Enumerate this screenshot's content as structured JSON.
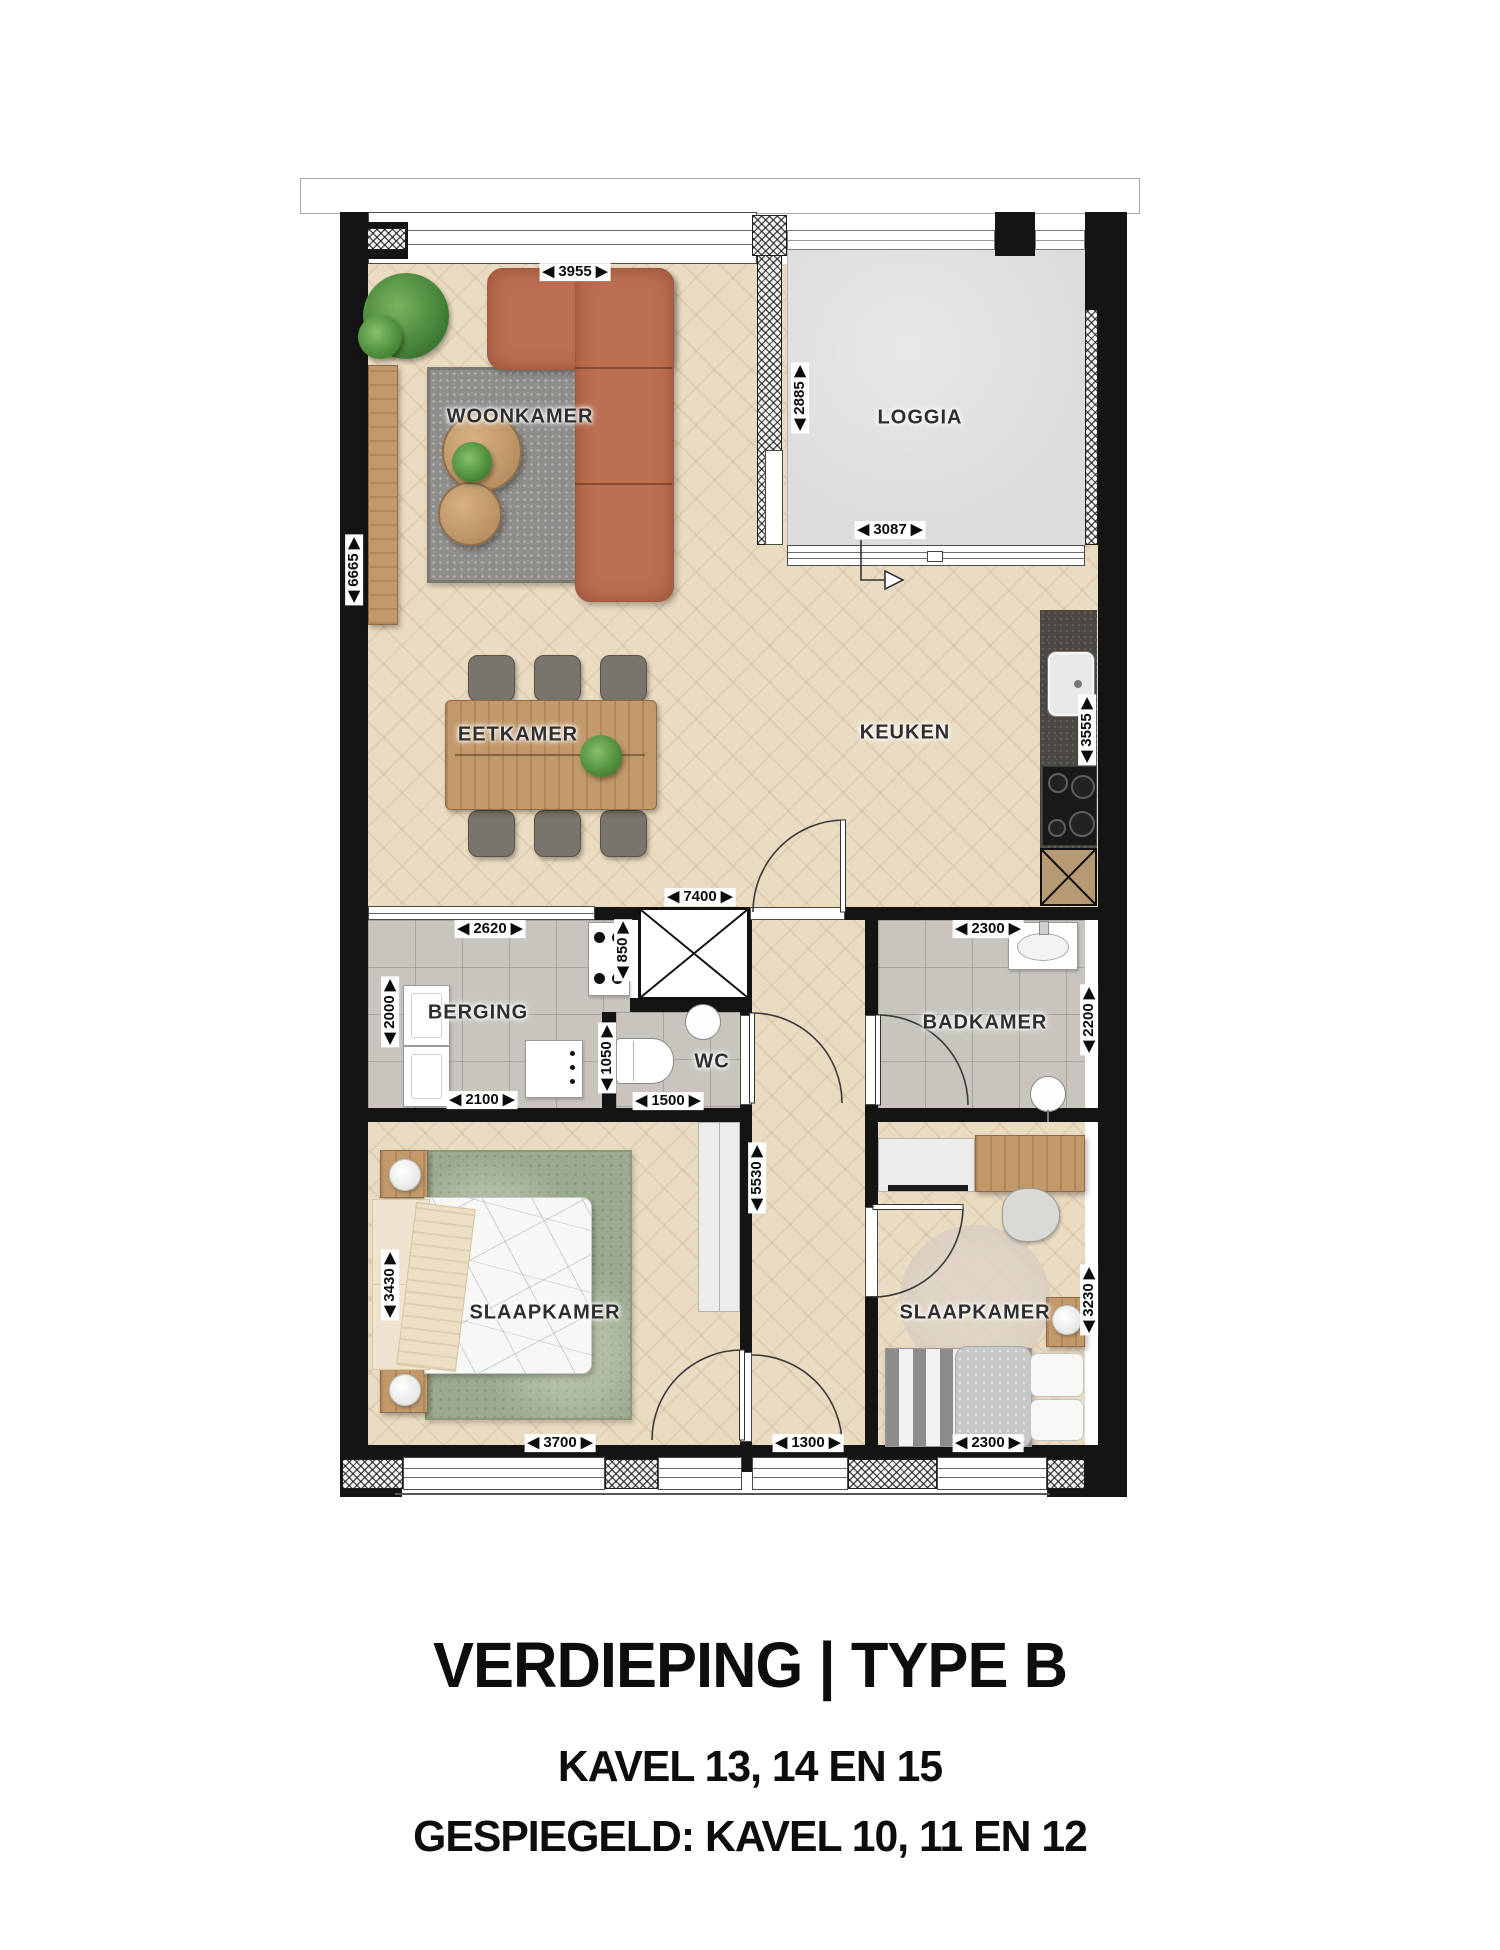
{
  "floorplan": {
    "rooms": {
      "woonkamer": {
        "label": "WOONKAMER"
      },
      "loggia": {
        "label": "LOGGIA"
      },
      "eetkamer": {
        "label": "EETKAMER"
      },
      "keuken": {
        "label": "KEUKEN"
      },
      "berging": {
        "label": "BERGING"
      },
      "wc": {
        "label": "WC"
      },
      "badkamer": {
        "label": "BADKAMER"
      },
      "slaapkamer_links": {
        "label": "SLAAPKAMER"
      },
      "slaapkamer_rechts": {
        "label": "SLAAPKAMER"
      }
    },
    "dimensions": {
      "d3955": {
        "label": "◀ 3955 ▶"
      },
      "d2885": {
        "label": "◀ 2885 ▶"
      },
      "d3087": {
        "label": "◀ 3087 ▶"
      },
      "d6665": {
        "label": "◀ 6665 ▶"
      },
      "d3555": {
        "label": "◀ 3555 ▶"
      },
      "d7400": {
        "label": "◀ 7400 ▶"
      },
      "d2620": {
        "label": "◀ 2620 ▶"
      },
      "d850": {
        "label": "◀ 850 ▶"
      },
      "d2000": {
        "label": "◀ 2000 ▶"
      },
      "d2100": {
        "label": "◀ 2100 ▶"
      },
      "d1050": {
        "label": "◀ 1050 ▶"
      },
      "d1500": {
        "label": "◀ 1500 ▶"
      },
      "d2300_badkamer": {
        "label": "◀ 2300 ▶"
      },
      "d2200": {
        "label": "◀ 2200 ▶"
      },
      "d5530": {
        "label": "◀ 5530 ▶"
      },
      "d3430": {
        "label": "◀ 3430 ▶"
      },
      "d3230": {
        "label": "◀ 3230 ▶"
      },
      "d3700": {
        "label": "◀ 3700 ▶"
      },
      "d1300": {
        "label": "◀ 1300 ▶"
      },
      "d2300_slaapkamer": {
        "label": "◀ 2300 ▶"
      }
    }
  },
  "footer": {
    "title": "VERDIEPING | TYPE B",
    "kavels": "KAVEL 13, 14 EN 15",
    "gespiegeld": "GESPIEGELD: KAVEL 10, 11 EN 12"
  },
  "colors": {
    "wall": "#141414",
    "wood": "#eadcc2",
    "tile": "#c8c5bf",
    "loggia": "#dcdcda",
    "counter": "#4b4742",
    "sofa": "#bc6f52",
    "rug": "#908e8b",
    "ruggreen": "#9cab90",
    "woodfurn": "#c2996b",
    "bedwhite": "#f7f7f6"
  }
}
